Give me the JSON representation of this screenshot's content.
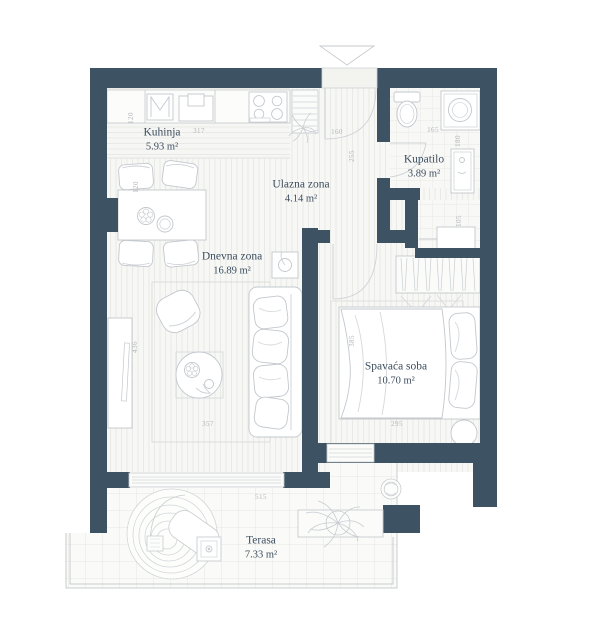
{
  "plan": {
    "rooms": [
      {
        "name": "Kuhinja",
        "area": "5.93 m²"
      },
      {
        "name": "Ulazna zona",
        "area": "4.14 m²"
      },
      {
        "name": "Kupatilo",
        "area": "3.89 m²"
      },
      {
        "name": "Dnevna zona",
        "area": "16.89 m²"
      },
      {
        "name": "Spavaća soba",
        "area": "10.70 m²"
      },
      {
        "name": "Terasa",
        "area": "7.33 m²"
      }
    ],
    "dimensions": [
      "120",
      "317",
      "120",
      "160",
      "255",
      "165",
      "180",
      "105",
      "436",
      "357",
      "385",
      "295",
      "515"
    ],
    "colors": {
      "wall": "#3d5363",
      "floor": "#f7f7f5",
      "furniture_line": "#c3c8cd",
      "label_text": "#3c4e5f",
      "dimension_text": "#b2b6ba"
    }
  }
}
